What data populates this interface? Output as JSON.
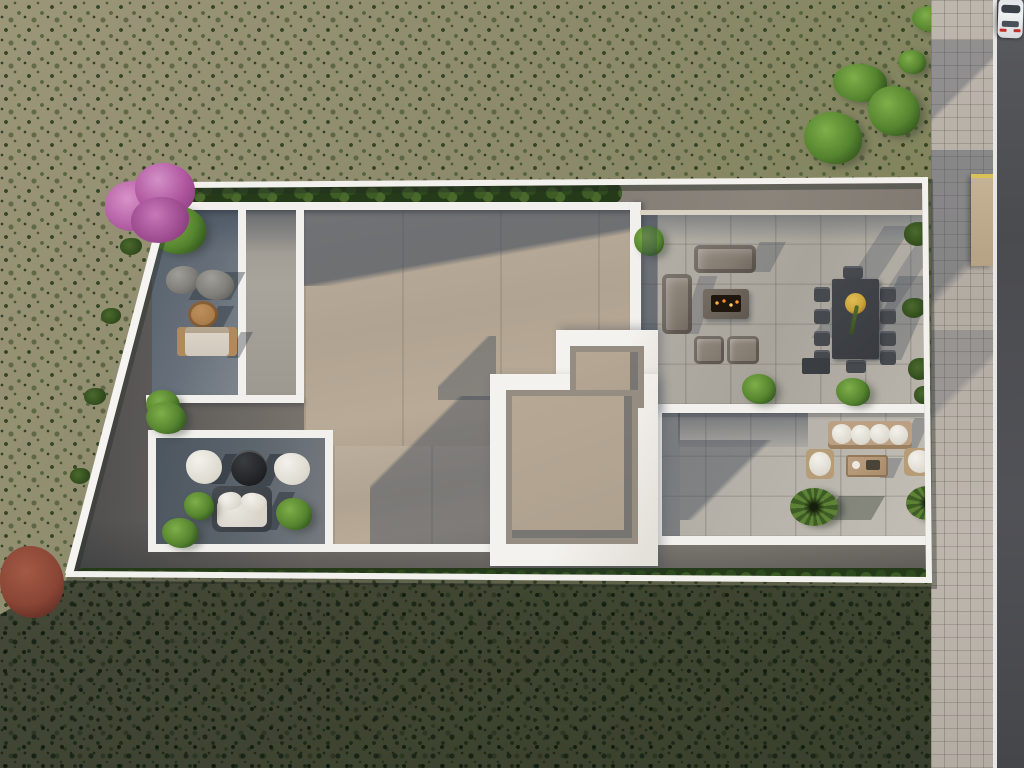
{
  "scene": {
    "title": "Aerial view of a modern flat-roof villa with furnished rooftop terraces",
    "setting": "Mediterranean scrubland plot bordered by a tiled sidewalk and asphalt road"
  },
  "palette": {
    "terrain": "#8f8a6b",
    "terrain_shadow": "#1a2a14",
    "scrub_green": "#3d5c26",
    "roof_tan": "#b3a593",
    "terrace_pavers": "#aca89f",
    "terrace_shadow_blue": "#5a6673",
    "wall_white": "#f3f1ed",
    "gravel": "#7b756d",
    "sidewalk": "#b7b0a7",
    "road_asphalt": "#4c4d51",
    "road_line": "#e8e6e2",
    "hedge_green": "#2e4a1e",
    "tree_green": "#55842f",
    "pink_tree": "#bb63ab",
    "red_shrub": "#8a4535",
    "fire_glow": "#ff9b2e",
    "dining_charcoal": "#3e4145",
    "brass_bowl": "#c9a23a",
    "wood": "#b08a5c",
    "car_body": "#e9eaec",
    "taillight_red": "#c03028"
  },
  "objects": {
    "road": "asphalt road",
    "road_line": "white edge line",
    "sidewalk": "grid-tiled sidewalk",
    "gate": "entry gate panel",
    "car": "white car driving on road",
    "boundary_wall": "white perimeter wall",
    "hedge_top": "hedge row along north wall",
    "hedge_bottom": "hedge row along south wall",
    "pink_tree": "pink flowering tree at northwest corner",
    "red_tree": "red shrub at southwest corner",
    "street_trees": "green trees near road",
    "main_roof": "tan concrete roof deck",
    "roof_volume": "raised white roof volume with two openings",
    "nw_terrace": "shaded northwest terrace",
    "nw_tree": "corner tree",
    "nw_boulders": "decorative boulders",
    "nw_round_table": "round wood coffee table",
    "nw_sofa": "beige garden sofa",
    "fire_sofa_top": "outdoor sofa",
    "fire_sofa_left": "outdoor sofa",
    "fire_table": "fire pit table with glowing coals",
    "fire_armchair": "outdoor armchair",
    "dining_table": "charcoal outdoor dining table",
    "dining_chair": "dining chair",
    "dining_bowl": "brass bowl centerpiece with plant",
    "sw_terrace": "southwest lounge terrace",
    "sw_armchair": "white lounge chair",
    "sw_table": "round black coffee table",
    "sw_sofa": "white garden sofa",
    "se_terrace": "southeast lounge terrace",
    "se_bench": "long bench with white cushions",
    "se_armchair": "white cushion armchair",
    "se_table": "wood coffee table",
    "palm": "palm shrub",
    "planter_shrub": "potted shrub",
    "wall_plant": "plant along wall"
  }
}
